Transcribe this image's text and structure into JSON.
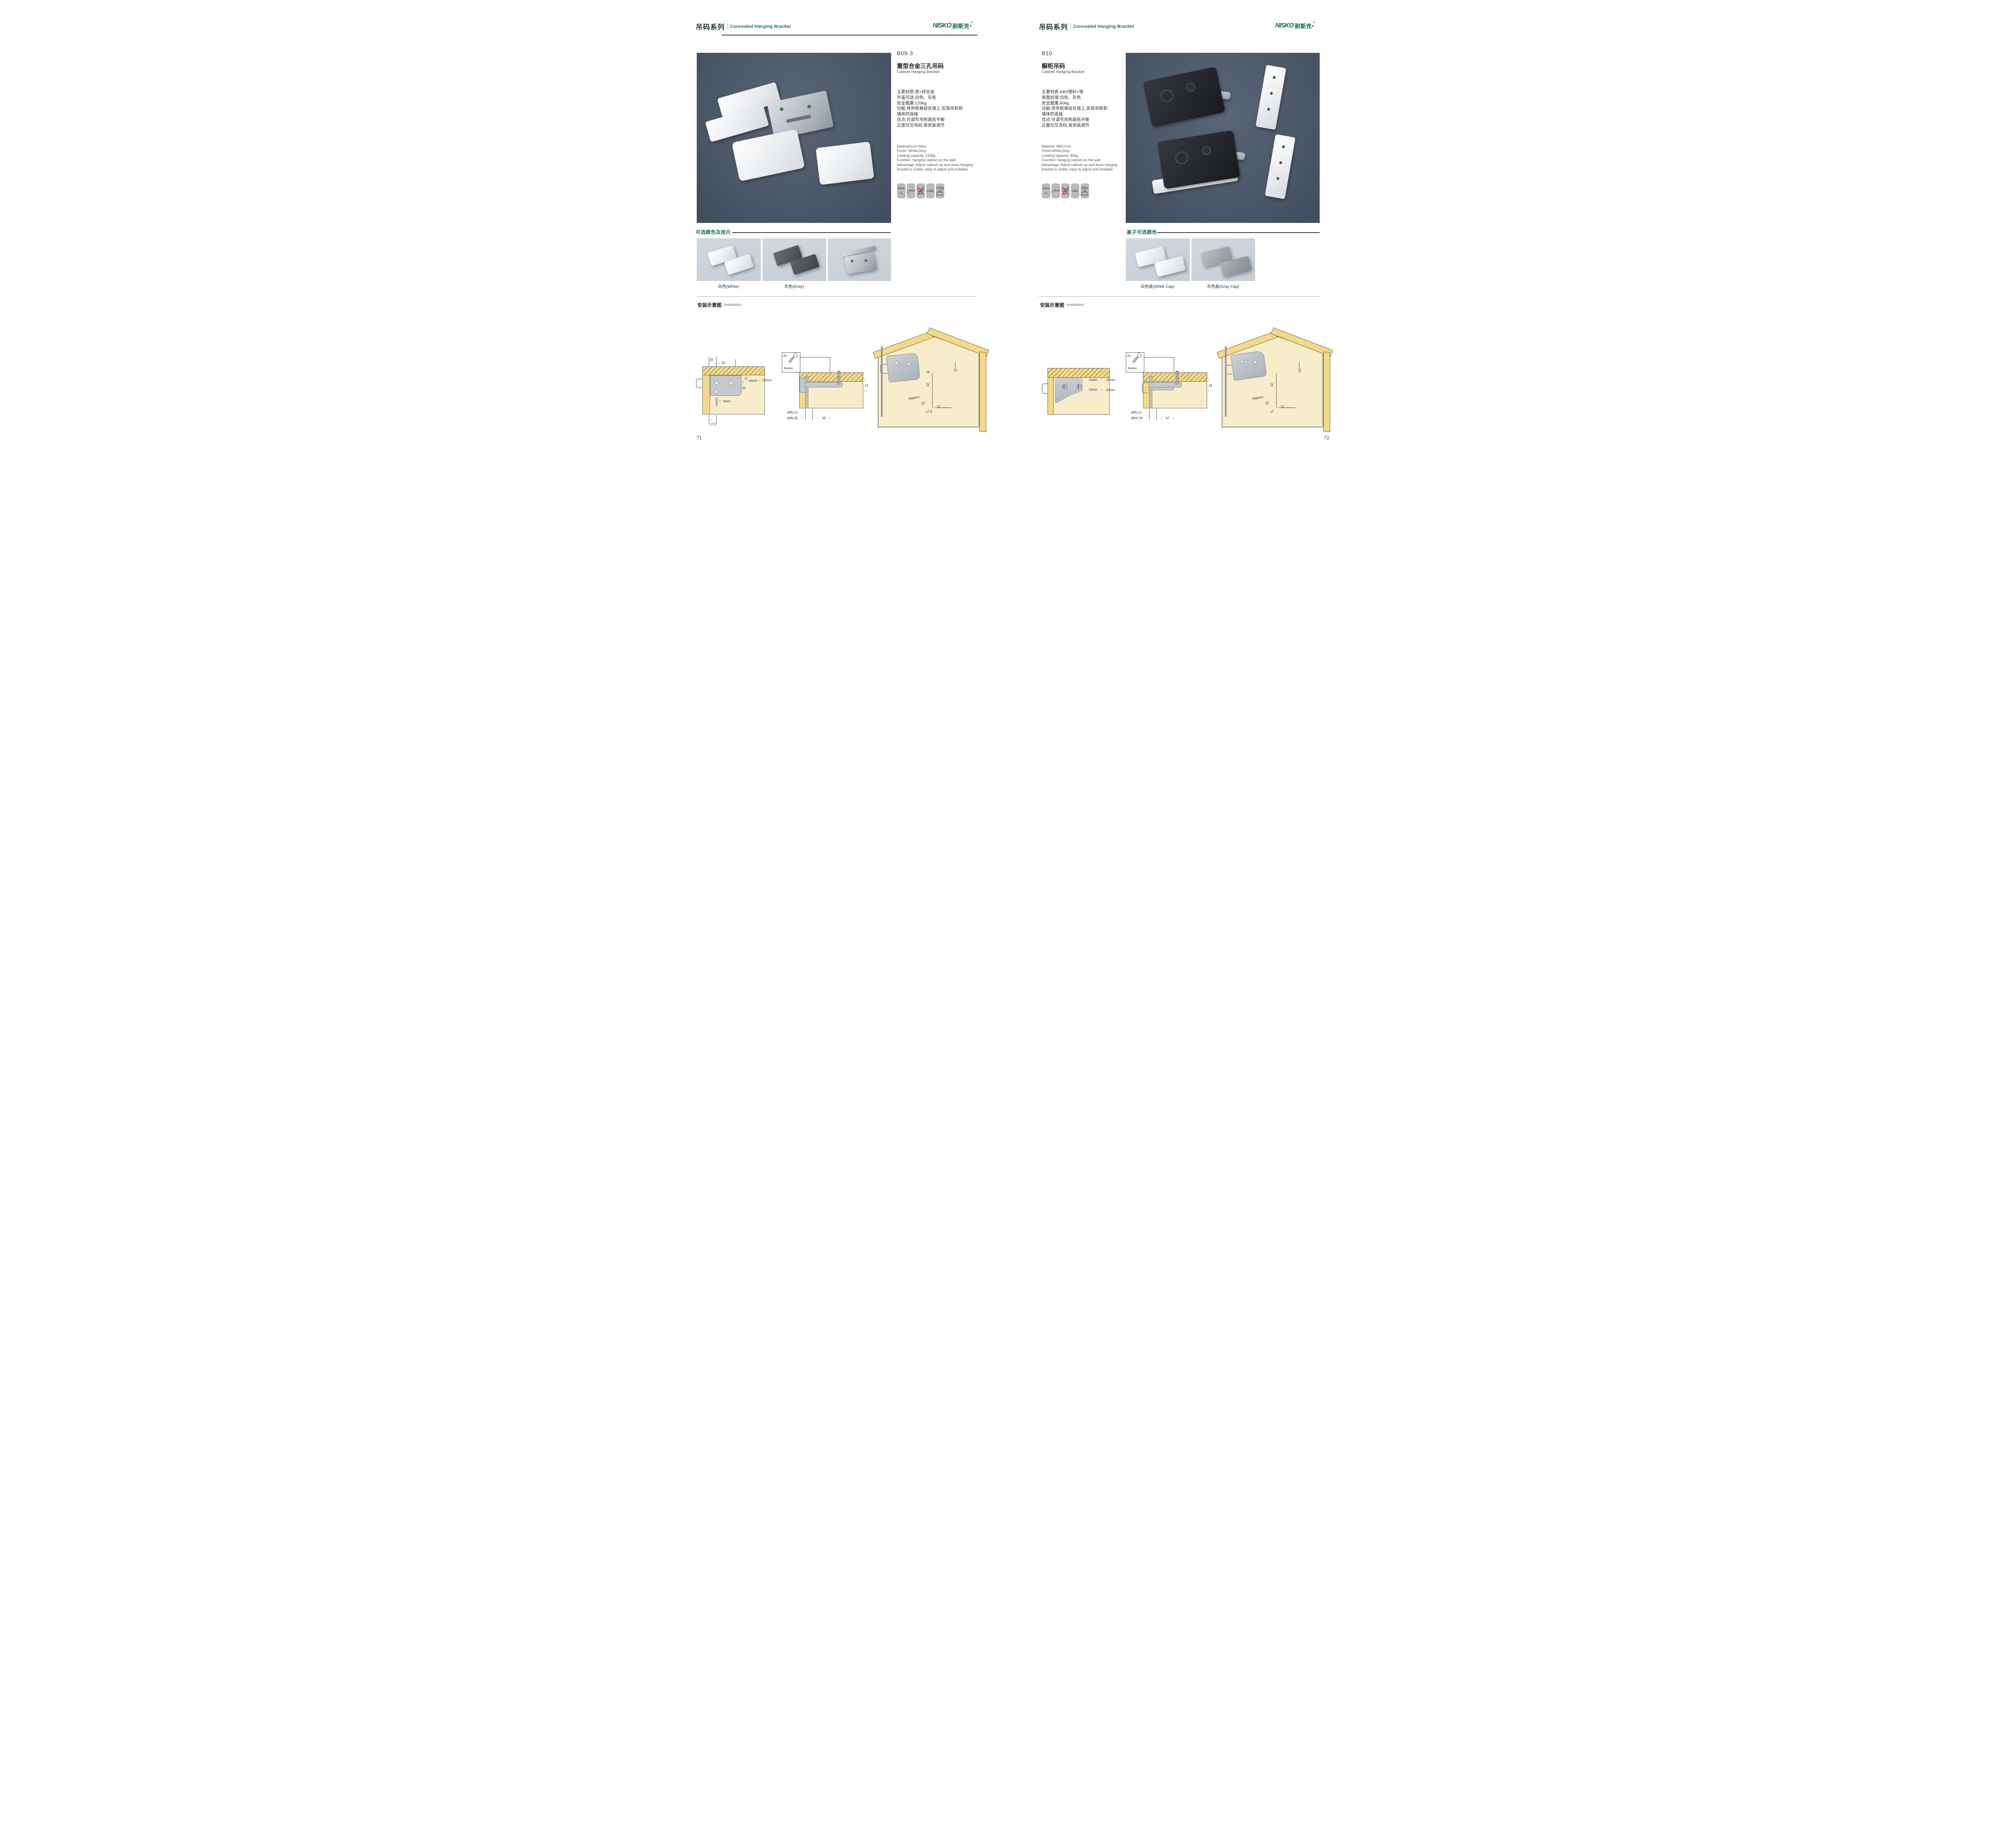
{
  "palette": {
    "brand_green": "#1b6f4e",
    "photo_bg": "#4d5868",
    "swatch_bg": "#ccd3d9",
    "badge_bg": "#b6babd",
    "wood_yellow": "#f4d985",
    "panel_cream": "#f8edca",
    "no_drill_red": "#cf3a3a"
  },
  "header": {
    "series_cn": "吊码系列",
    "series_en": "Concealed Hanging Bracket",
    "logo_text": "NISKO",
    "logo_cn": "耐斯克",
    "logo_reg": "®"
  },
  "pages": [
    {
      "page_number": "71",
      "product": {
        "code": "B09-3",
        "name_cn": "重型合金三孔吊码",
        "name_en": "Cabinet Hanging Bracket"
      },
      "specs_cn": [
        "主要材质:铁+锌合金",
        "外盖可选:白色、灰色",
        "安全载重:120kg",
        "功能:将吊柜悬挂在墙上,实现吊柜和",
        "墙体的连接",
        "优点:可调节吊柜高低平衡",
        "正面可见吊码,易安装调节"
      ],
      "specs_en": [
        "Material:Iron+Alloy",
        "Finish: White,Grey",
        "Loading capacity: 120kg",
        "Function: hanging cabinet on the wall",
        "Advantage: Adjust cabinet up and down hanging",
        "bracket is visible, easy to adjust and installed"
      ],
      "badges": {
        "width_label": "20mm",
        "height_label": "6mm",
        "cert_label": "LGA",
        "load_label": "120Kg"
      },
      "colors": {
        "title": "可选颜色及挂片",
        "caption_1": "白色(White)",
        "caption_2": "灰色(Gray)"
      },
      "install": {
        "title_cn": "安装示意图",
        "title_en": "Installation",
        "d1": {
          "t1": "16",
          "t2": "32",
          "r1": "17",
          "r2": "25",
          "h_label": "20mm",
          "v_label": "6mm",
          "b1": "17.5"
        },
        "d2": {
          "count": "2x",
          "dia": "Φ4mm",
          "r1": "12",
          "b1": "MIN.12",
          "b2": "MIN.35",
          "b3": "58"
        },
        "d3": {
          "dim_a": "17",
          "dim_b": "16",
          "dim_c": "42",
          "rmax": "RMAX4",
          "dim_d": "16",
          "dim_e": "32",
          "dim_f": "17.5"
        }
      }
    },
    {
      "page_number": "72",
      "product": {
        "code": "B10",
        "name_cn": "橱柜吊码",
        "name_en": "Cabinet Hanging Bracket"
      },
      "specs_cn": [
        "主要材质:ABS塑料+铁",
        "表面处理:白色、灰色",
        "安全载重:80kg",
        "功能:将吊柜悬挂在墙上,实现吊柜和",
        "墙体的连接",
        "优点:可调节吊柜高低平衡",
        "正面可见吊码,易安装调节"
      ],
      "specs_en": [
        "Material: ABS+iron",
        "Finish:White,Grey",
        "Loading capacity: 80kg",
        "Function: hanging cabinet on the wall",
        "Advantage: Adjust cabinet up and down hanging",
        "bracket is visible, easy to adjust and installed"
      ],
      "badges": {
        "width_label": "10mm",
        "height_label": "15mm",
        "cert_label": "LGA",
        "load_label": "80Kg"
      },
      "colors": {
        "title": "盖子可选颜色",
        "caption_1": "白色盖(White Cap)",
        "caption_2": "灰色盖(Gray Cap)"
      },
      "install": {
        "title_cn": "安装示意图",
        "title_en": "Installation",
        "d1": {
          "v_label": "15mm",
          "h_label": "10mm"
        },
        "d2": {
          "count": "2x",
          "dia": "Φ4mm",
          "r1": "18",
          "b1": "MIN.12",
          "b2": "MAX.30",
          "b3": "67"
        },
        "d3": {
          "dim_a": "13",
          "dim_c": "42",
          "rmax": "RMAX4",
          "dim_d": "19",
          "dim_e": "32",
          "dim_f": "17"
        }
      }
    }
  ]
}
